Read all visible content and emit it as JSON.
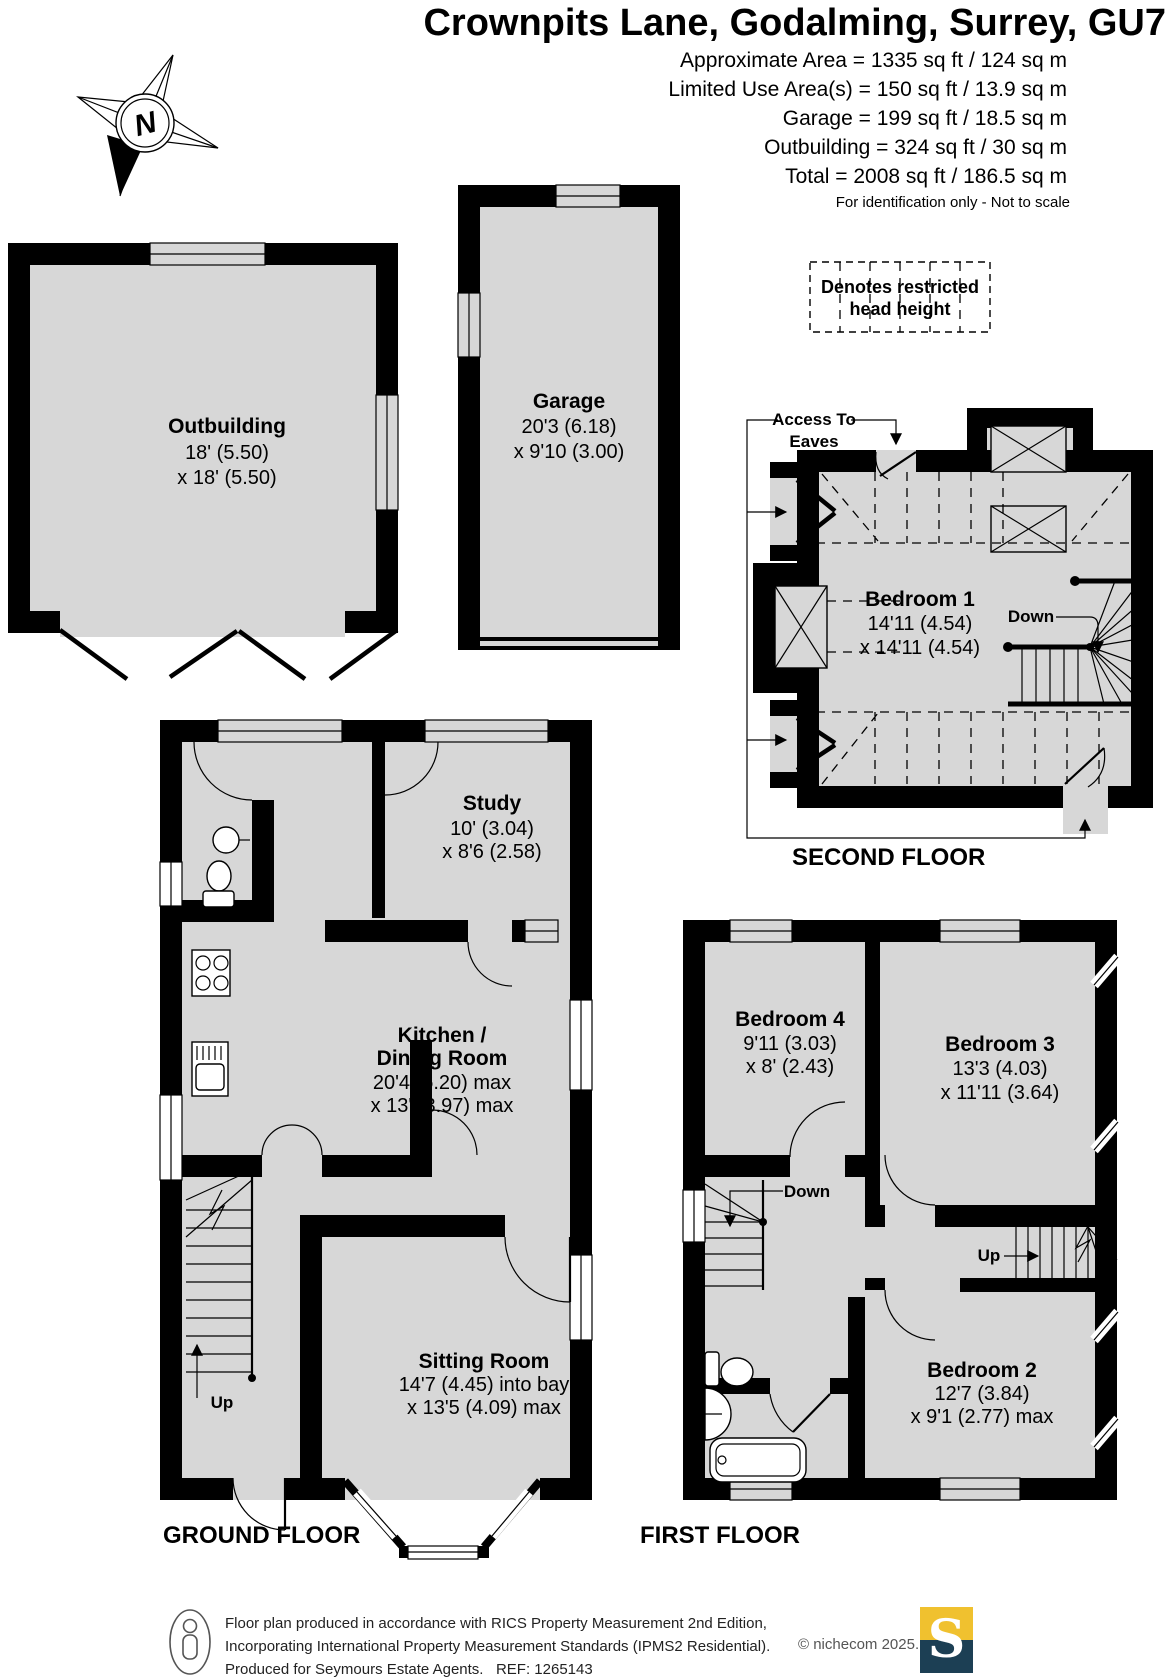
{
  "header": {
    "title": "Crownpits Lane, Godalming, Surrey, GU7",
    "area_lines": [
      "Approximate Area = 1335 sq ft / 124 sq m",
      "Limited Use Area(s) = 150 sq ft / 13.9 sq m",
      "Garage = 199 sq ft / 18.5 sq m",
      "Outbuilding = 324 sq ft / 30 sq m",
      "Total = 2008 sq ft / 186.5 sq m"
    ],
    "disclaimer": "For identification only - Not to scale"
  },
  "legend": {
    "line1": "Denotes restricted",
    "line2": "head height"
  },
  "compass": {
    "north": "N"
  },
  "annotations": {
    "access1": "Access To",
    "access2": "Eaves",
    "down_second": "Down",
    "up_ground": "Up",
    "down_first": "Down",
    "up_first": "Up"
  },
  "rooms": {
    "outbuilding": {
      "name": "Outbuilding",
      "dim1": "18' (5.50)",
      "dim2": "x 18' (5.50)"
    },
    "garage": {
      "name": "Garage",
      "dim1": "20'3 (6.18)",
      "dim2": "x 9'10 (3.00)"
    },
    "bedroom1": {
      "name": "Bedroom 1",
      "dim1": "14'11 (4.54)",
      "dim2": "x 14'11 (4.54)"
    },
    "study": {
      "name": "Study",
      "dim1": "10' (3.04)",
      "dim2": "x 8'6 (2.58)"
    },
    "kitchen": {
      "name1": "Kitchen /",
      "name2": "Dining Room",
      "dim1": "20'4 (6.20) max",
      "dim2": "x 13' (3.97) max"
    },
    "sitting": {
      "name": "Sitting Room",
      "dim1": "14'7 (4.45) into bay",
      "dim2": "x 13'5 (4.09) max"
    },
    "bedroom4": {
      "name": "Bedroom 4",
      "dim1": "9'11 (3.03)",
      "dim2": "x 8' (2.43)"
    },
    "bedroom3": {
      "name": "Bedroom 3",
      "dim1": "13'3 (4.03)",
      "dim2": "x 11'11 (3.64)"
    },
    "bedroom2": {
      "name": "Bedroom 2",
      "dim1": "12'7 (3.84)",
      "dim2": "x 9'1 (2.77) max"
    }
  },
  "floor_labels": {
    "second": "SECOND FLOOR",
    "ground": "GROUND FLOOR",
    "first": "FIRST FLOOR"
  },
  "footer": {
    "line1": "Floor plan produced in accordance with RICS Property Measurement 2nd Edition,",
    "line2": "Incorporating International Property Measurement Standards (IPMS2 Residential).",
    "line3": "Produced for Seymours Estate Agents.   REF: 1265143",
    "copyright": "© nichecom 2025.",
    "logo_letter": "S"
  },
  "colors": {
    "floor": "#d7d7d7",
    "wall": "#000000",
    "logo_yellow": "#F0C12F",
    "logo_navy": "#1C3F54"
  }
}
